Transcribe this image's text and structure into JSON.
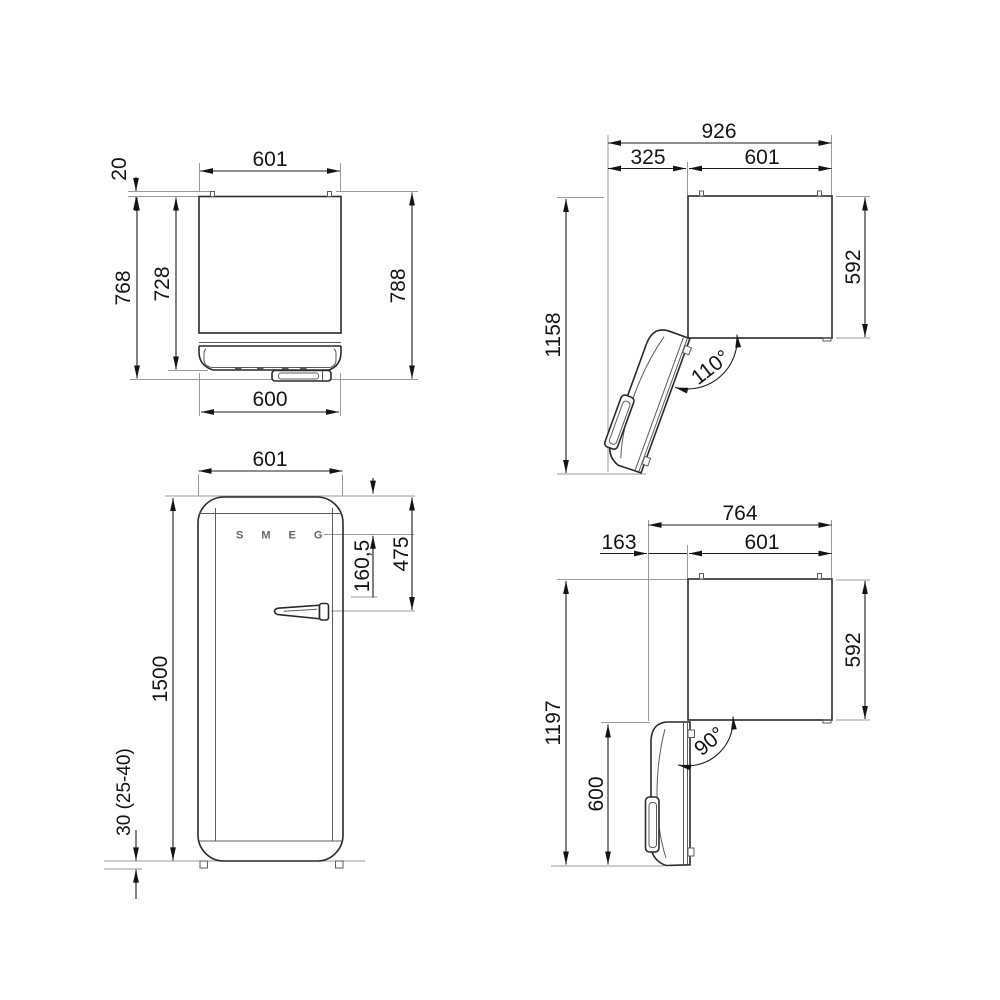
{
  "brand_logo": "SMEG",
  "views": {
    "plan_closed": {
      "hinge_protrusion": "20",
      "width": "601",
      "depth_to_door": "768",
      "depth_body": "728",
      "depth_overall": "788",
      "door_width": "600"
    },
    "front": {
      "width": "601",
      "logo_from_top": "160,5",
      "handle_from_top": "475",
      "height": "1500",
      "feet_height": "30 (25-40)"
    },
    "plan_open_110": {
      "overall_width": "926",
      "door_clearance": "325",
      "width": "601",
      "depth_body": "592",
      "overall_depth": "1158",
      "door_angle": "110°"
    },
    "plan_open_90": {
      "overall_width": "764",
      "door_clearance": "163",
      "width": "601",
      "depth_body": "592",
      "overall_depth": "1197",
      "door_depth": "600",
      "door_angle": "90°"
    }
  }
}
